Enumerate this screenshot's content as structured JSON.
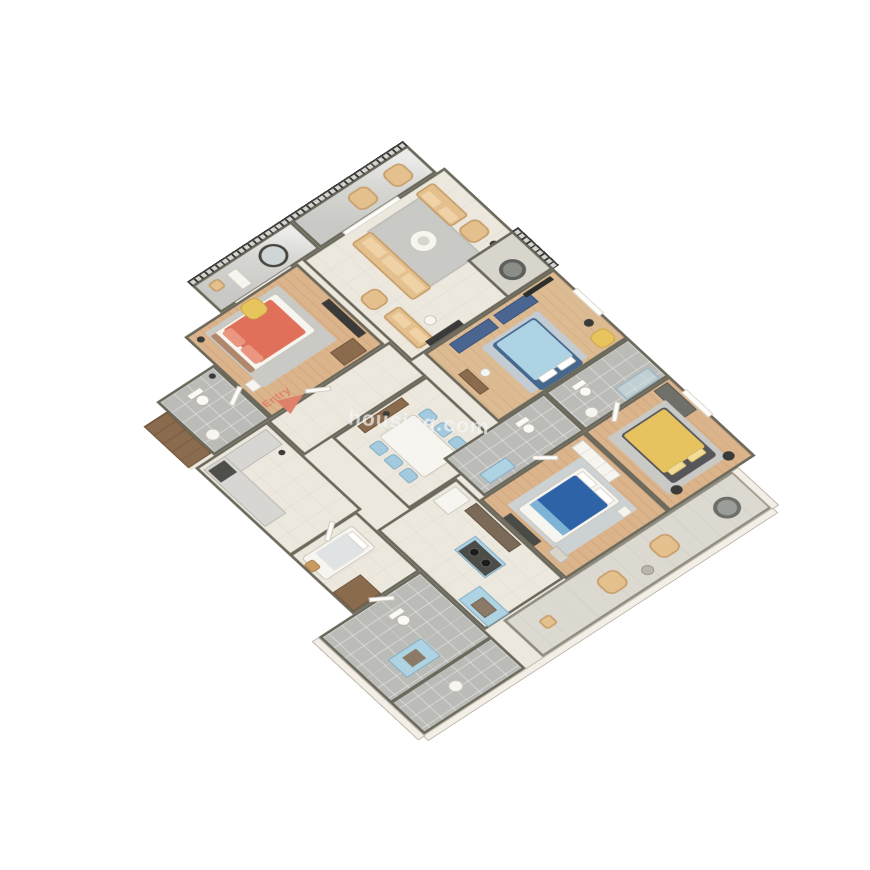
{
  "scene": {
    "type": "isometric-3d-floorplan",
    "description": "3D cutaway floor plan of a multi-bedroom apartment viewed from above at an angle, transparent background"
  },
  "watermark": {
    "text": "housing.com"
  },
  "entry_marker": {
    "label": "Entry",
    "color": "#df8168"
  },
  "palette": {
    "wall": "#6b685c",
    "wallFace": "#f2eee5",
    "floorCream": "#ece8de",
    "floorWood": "#dcb48c",
    "floorWood2": "#ddbb92",
    "floorTile": "#bbbbb8",
    "floorMarble": "#d6d6d3",
    "terraceFloor": "#dcd9d1",
    "railing": "#3b3933",
    "parapet": "#f3efe6",
    "bedRed": "#e0705a",
    "bedBlueLight": "#aed3e4",
    "bedNavy": "#2e63a8",
    "bedYellow": "#e7c35f",
    "sofaTan": "#e4c08e",
    "chairBlue": "#a3cade",
    "cabinetBlue": "#aed3e3",
    "wardrobeNavy": "#4a6690",
    "woodBrown": "#8a6b4e",
    "rugGray": "#c9c9c6",
    "white": "#f7f5f0",
    "dark": "#3a3a38",
    "counterDark": "#4c4c48",
    "accentYellow": "#e8c45e",
    "entryColor": "#df8168"
  },
  "rooms": [
    {
      "id": "balcony-living",
      "label": "balcony with iron railing",
      "floor": "marble",
      "furniture": [
        "tan armchair",
        "tan armchair"
      ]
    },
    {
      "id": "balcony-bedroom-1",
      "label": "balcony with iron railing",
      "floor": "marble",
      "furniture": [
        "round mirror",
        "white bench",
        "planter"
      ]
    },
    {
      "id": "living-room",
      "label": "living room",
      "floor": "cream",
      "furniture": [
        "three-seater sofa",
        "loveseat",
        "armchair",
        "two-seater sofa",
        "armchair",
        "gray rug",
        "round coffee table",
        "floor lamp",
        "tv bench"
      ]
    },
    {
      "id": "recessed-balcony",
      "label": "recessed balcony",
      "floor": "stone",
      "furniture": [
        "papasan chair"
      ]
    },
    {
      "id": "bedroom-1",
      "label": "bedroom with coral bed",
      "floor": "wood",
      "furniture": [
        "double bed coral duvet",
        "gray rug",
        "yellow armchair",
        "tv unit",
        "dresser",
        "side table",
        "floor lamp"
      ]
    },
    {
      "id": "bathroom-1",
      "label": "bathroom",
      "floor": "gray tile",
      "furniture": [
        "toilet",
        "washbasin",
        "lamp"
      ]
    },
    {
      "id": "hall-wardrobe",
      "label": "wardrobe unit",
      "floor": "",
      "furniture": [
        "brown wardrobe"
      ]
    },
    {
      "id": "foyer",
      "label": "entry foyer",
      "floor": "cream",
      "furniture": [
        "entry arrow"
      ]
    },
    {
      "id": "dining-area",
      "label": "dining area",
      "floor": "cream",
      "furniture": [
        "white dining table",
        "six light-blue chairs",
        "wooden console",
        "vase"
      ]
    },
    {
      "id": "study-utility",
      "label": "utility room",
      "floor": "cream",
      "furniture": [
        "L-shaped marble counter",
        "appliance",
        "lamp"
      ]
    },
    {
      "id": "kitchen",
      "label": "kitchen",
      "floor": "cream tile",
      "furniture": [
        "brown counter",
        "refrigerator",
        "hob island light-blue",
        "sink counter light-blue"
      ]
    },
    {
      "id": "maid-room",
      "label": "small bedroom",
      "floor": "cream",
      "furniture": [
        "single bed",
        "brown wardrobe",
        "wooden stool"
      ]
    },
    {
      "id": "bathroom-south",
      "label": "large bathroom / dressing",
      "floor": "gray tile",
      "furniture": [
        "toilet",
        "light-blue vanity",
        "washbasin"
      ]
    },
    {
      "id": "bedroom-2",
      "label": "bedroom with light-blue bed",
      "floor": "wood",
      "furniture": [
        "double bed light-blue",
        "navy wardrobe",
        "navy wardrobe",
        "rug",
        "desk",
        "chair",
        "tv panel",
        "yellow armchair",
        "stool"
      ]
    },
    {
      "id": "bathroom-2",
      "label": "bathroom with shower",
      "floor": "gray tile",
      "furniture": [
        "shower enclosure",
        "toilet",
        "washbasin"
      ]
    },
    {
      "id": "bathroom-3",
      "label": "bathroom",
      "floor": "gray tile",
      "furniture": [
        "toilet",
        "light-blue vanity"
      ]
    },
    {
      "id": "bedroom-3",
      "label": "bedroom with yellow bed",
      "floor": "wood",
      "furniture": [
        "double bed yellow duvet",
        "gray dresser",
        "gray rug",
        "two dark stools"
      ]
    },
    {
      "id": "master-bedroom",
      "label": "bedroom with navy bed",
      "floor": "wood",
      "furniture": [
        "double bed navy duvet white frame",
        "white wardrobe",
        "light rug",
        "side table",
        "tv dresser",
        "bench"
      ]
    },
    {
      "id": "terrace",
      "label": "terrace with parapet",
      "floor": "light tile",
      "furniture": [
        "hanging egg chair",
        "tan armchair",
        "tan armchair",
        "side table",
        "planter"
      ]
    }
  ]
}
